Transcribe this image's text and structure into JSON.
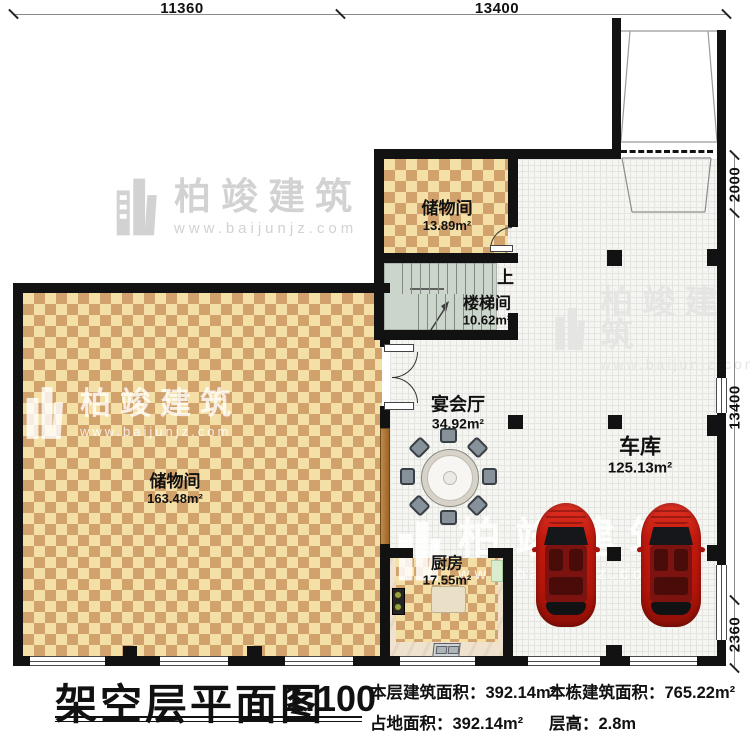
{
  "title": {
    "text": "架空层平面图",
    "scale": "1:100"
  },
  "footer": {
    "items": [
      {
        "label": "本层建筑面积：",
        "value": "392.14m²"
      },
      {
        "label": "本栋建筑面积：",
        "value": "765.22m²"
      },
      {
        "label": "占地面积：",
        "value": "392.14m²"
      },
      {
        "label": "层高：",
        "value": "2.8m"
      }
    ]
  },
  "dims": {
    "top": [
      "11360",
      "13400"
    ],
    "right": [
      "2000",
      "13400",
      "2360"
    ]
  },
  "rooms": {
    "storage_small": {
      "name": "储物间",
      "area": "13.89m²"
    },
    "stairwell": {
      "name": "楼梯间",
      "area": "10.62m²",
      "up": "上"
    },
    "banquet": {
      "name": "宴会厅",
      "area": "34.92m²"
    },
    "garage": {
      "name": "车库",
      "area": "125.13m²"
    },
    "storage_large": {
      "name": "储物间",
      "area": "163.48m²"
    },
    "kitchen": {
      "name": "厨房",
      "area": "17.55m²"
    }
  },
  "watermark": {
    "brand": "柏竣建筑",
    "url": "www.baijunjz.com"
  },
  "colors": {
    "wall": "#121212",
    "floor_light": "#f4dfa6",
    "floor_dark": "#d2a26d",
    "car": "#c41a0e",
    "stair_floor": "#ccd5cb"
  }
}
